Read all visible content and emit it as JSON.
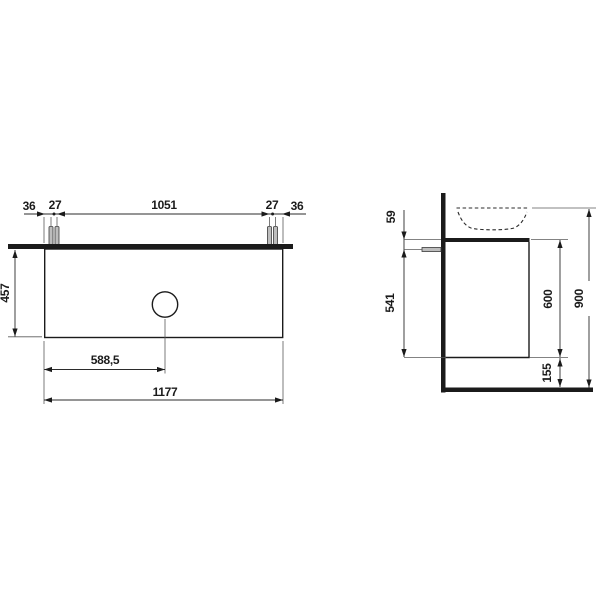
{
  "drawing": {
    "type": "technical-dimension-drawing",
    "subject": "vanity-cabinet-with-countertop-and-washbasin",
    "units": "mm",
    "line_color": "#1b1b1b",
    "background": "#ffffff",
    "front_view": {
      "dim_left_36": "36",
      "dim_left_27": "27",
      "dim_top_1051": "1051",
      "dim_right_27": "27",
      "dim_right_36": "36",
      "dim_height_457": "457",
      "dim_basin_center_588_5": "588,5",
      "dim_total_width_1177": "1177"
    },
    "side_view": {
      "dim_top_59": "59",
      "dim_fixing_541": "541",
      "dim_cabinet_height_600": "600",
      "dim_plinth_155": "155",
      "dim_total_height_900": "900"
    }
  }
}
